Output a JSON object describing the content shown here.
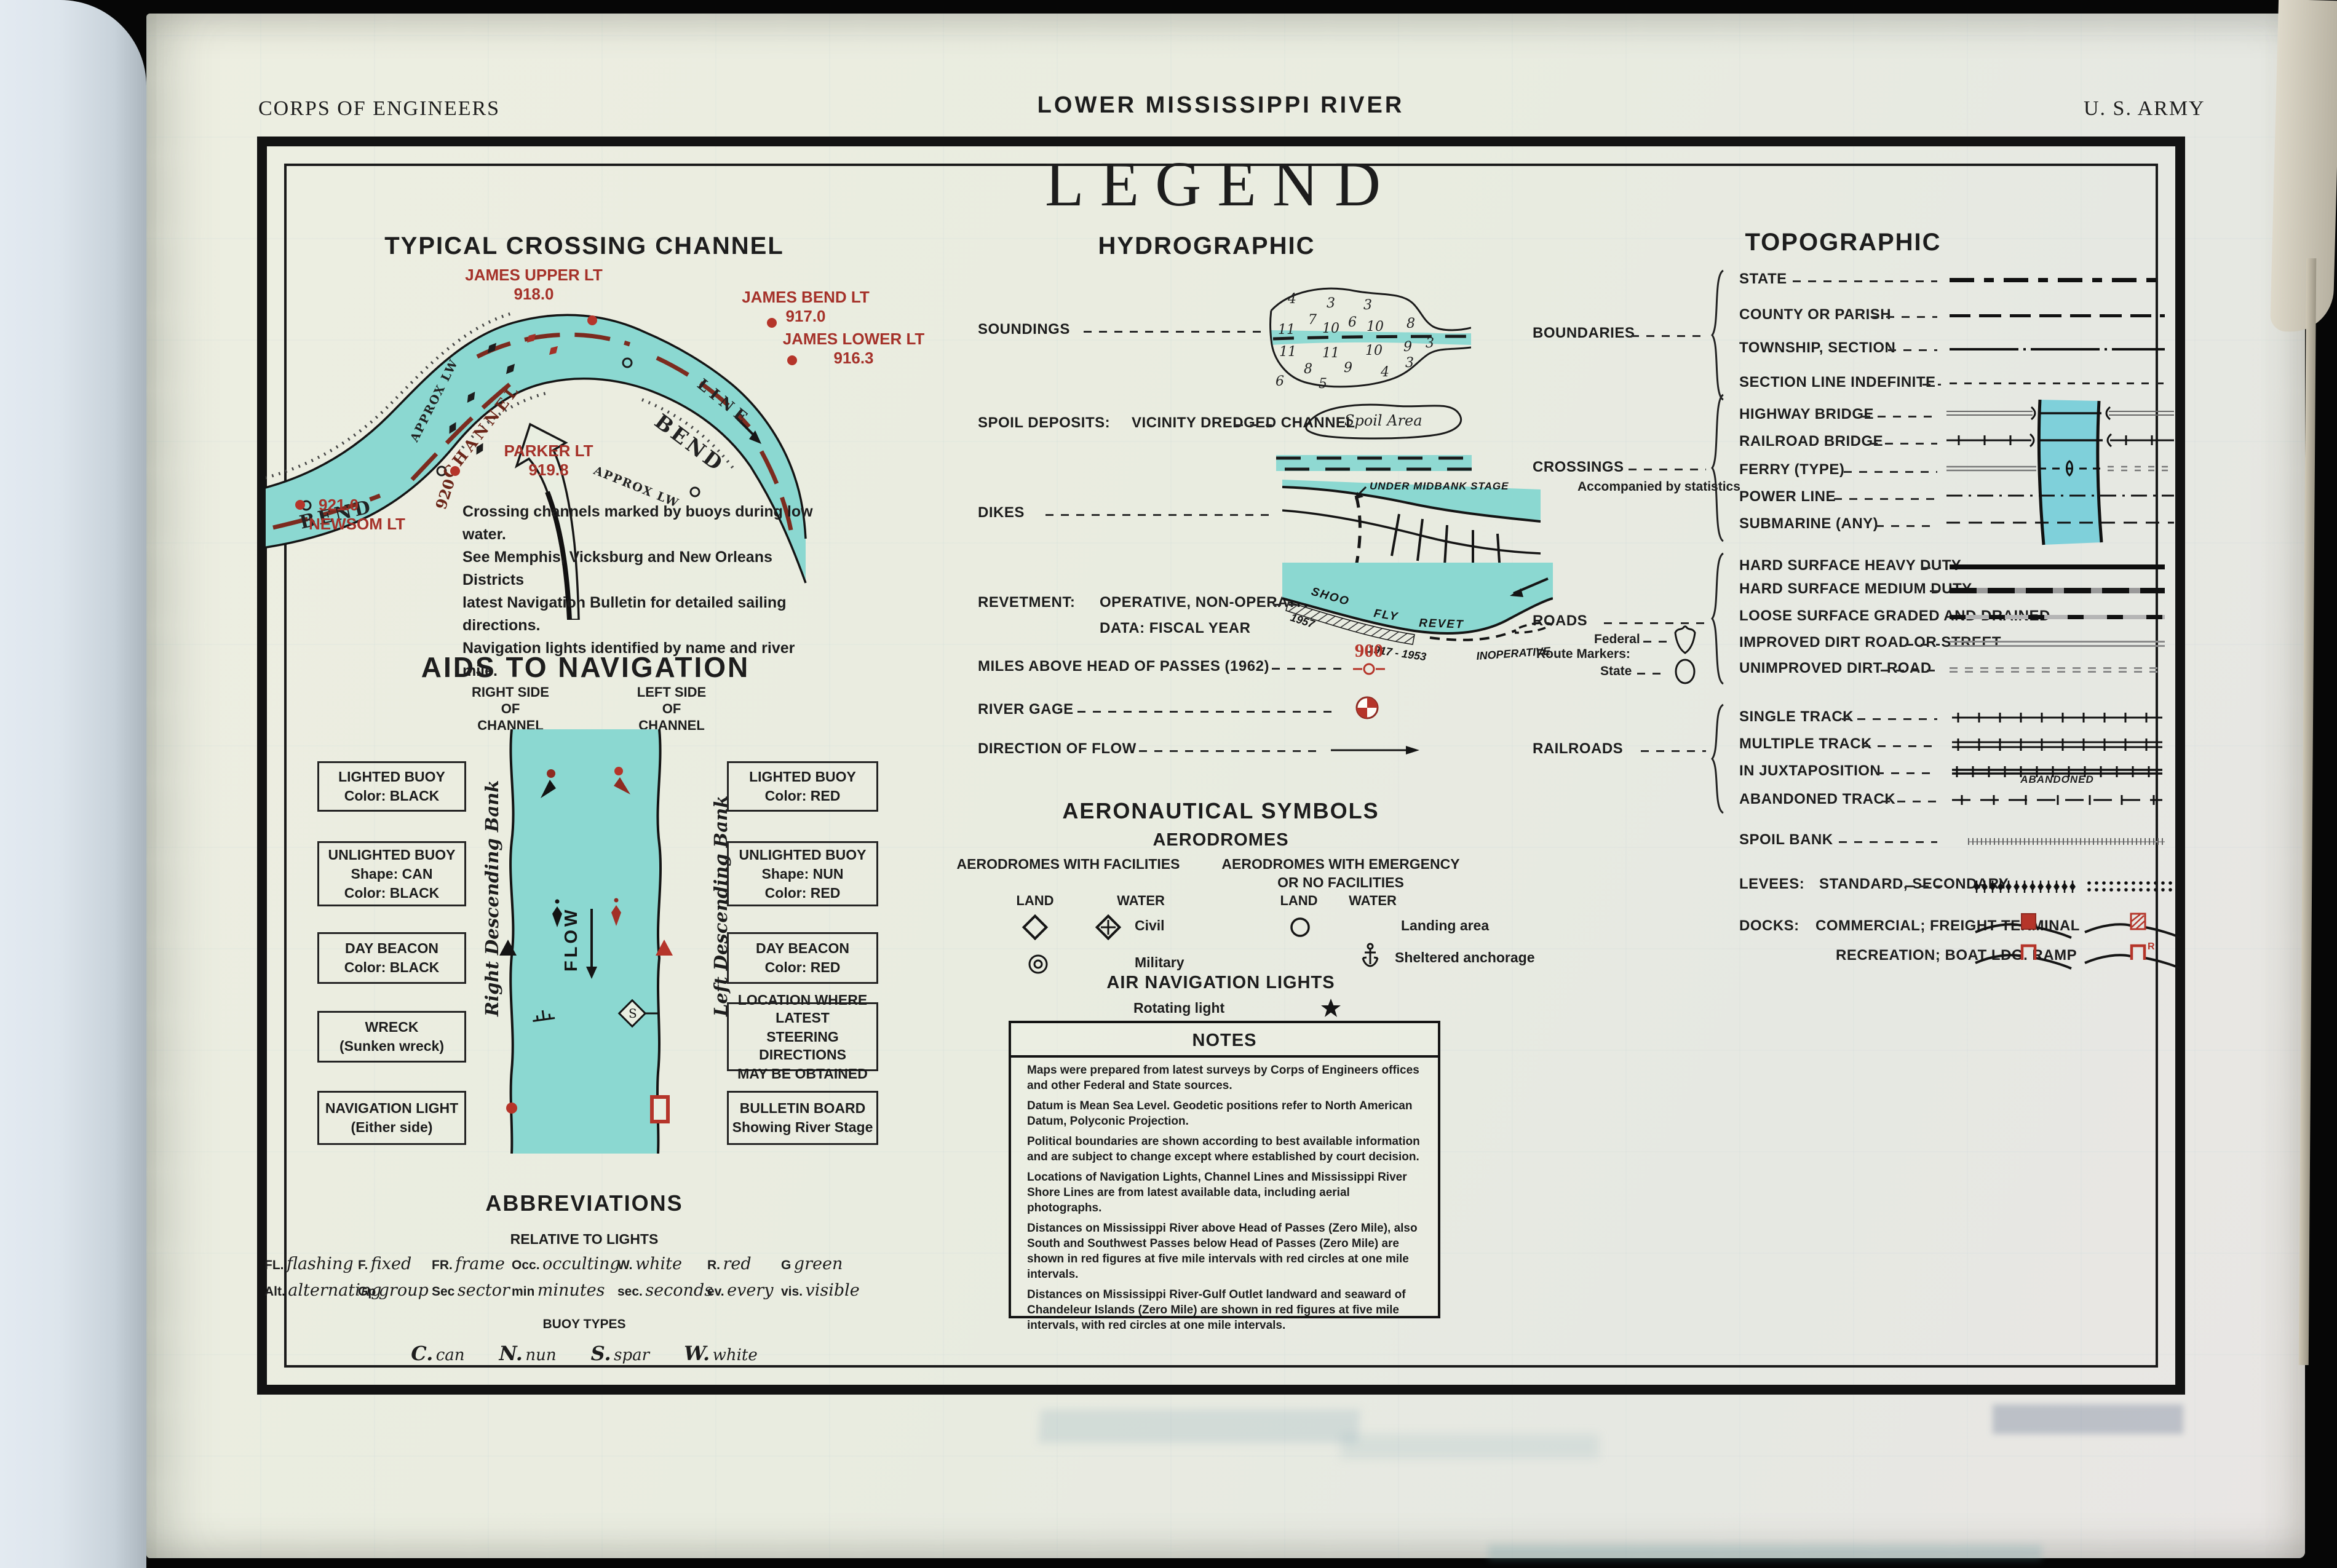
{
  "header": {
    "corps": "CORPS OF ENGINEERS",
    "river": "LOWER MISSISSIPPI RIVER",
    "army": "U. S. ARMY",
    "legend": "LEGEND"
  },
  "crossing": {
    "heading": "TYPICAL CROSSING CHANNEL",
    "james_upper": {
      "name": "JAMES UPPER LT",
      "mile": "918.0"
    },
    "james_bend": {
      "name": "JAMES BEND LT",
      "mile": "917.0"
    },
    "james_lower": {
      "name": "JAMES LOWER LT",
      "mile": "916.3"
    },
    "parker": {
      "name": "PARKER LT",
      "mile": "919.8"
    },
    "newsom": {
      "mile": "921.0",
      "name": "NEWSOM LT"
    },
    "words": {
      "bend_left": "BEND",
      "mile920": "920",
      "channel": "CHANNEL",
      "approx_lw": "APPROX LW",
      "line": "LINE",
      "bend_right": "BEND"
    },
    "note_lines": [
      "Crossing channels marked by buoys during low water.",
      "See Memphis, Vicksburg and New Orleans Districts",
      "latest Navigation Bulletin for detailed sailing directions.",
      "Navigation lights identified by name and river mile."
    ]
  },
  "aids": {
    "heading": "AIDS TO NAVIGATION",
    "right_side": [
      "RIGHT SIDE",
      "OF",
      "CHANNEL"
    ],
    "left_side": [
      "LEFT SIDE",
      "OF",
      "CHANNEL"
    ],
    "right_bank": "Right Descending Bank",
    "left_bank": "Left Descending Bank",
    "flow": "FLOW",
    "s_marker": "S",
    "left_boxes": [
      {
        "lines": [
          "LIGHTED BUOY",
          "Color: BLACK"
        ]
      },
      {
        "lines": [
          "UNLIGHTED BUOY",
          "Shape: CAN",
          "Color: BLACK"
        ]
      },
      {
        "lines": [
          "DAY BEACON",
          "Color: BLACK"
        ]
      },
      {
        "lines": [
          "WRECK",
          "(Sunken wreck)"
        ]
      },
      {
        "lines": [
          "NAVIGATION LIGHT",
          "(Either side)"
        ]
      }
    ],
    "right_boxes": [
      {
        "lines": [
          "LIGHTED BUOY",
          "Color: RED"
        ]
      },
      {
        "lines": [
          "UNLIGHTED BUOY",
          "Shape: NUN",
          "Color: RED"
        ]
      },
      {
        "lines": [
          "DAY BEACON",
          "Color: RED"
        ]
      },
      {
        "lines": [
          "LOCATION WHERE LATEST",
          "STEERING DIRECTIONS",
          "MAY BE OBTAINED"
        ]
      },
      {
        "lines": [
          "BULLETIN BOARD",
          "Showing River Stage"
        ]
      }
    ]
  },
  "abbr": {
    "heading": "ABBREVIATIONS",
    "lights_heading": "RELATIVE TO LIGHTS",
    "row1": [
      {
        "a": "FL.",
        "t": "flashing"
      },
      {
        "a": "F.",
        "t": "fixed"
      },
      {
        "a": "FR.",
        "t": "frame"
      },
      {
        "a": "Occ.",
        "t": "occulting"
      },
      {
        "a": "W.",
        "t": "white"
      },
      {
        "a": "R.",
        "t": "red"
      },
      {
        "a": "G",
        "t": "green"
      }
    ],
    "row2": [
      {
        "a": "Alt.",
        "t": "alternating"
      },
      {
        "a": "Gp",
        "t": "group"
      },
      {
        "a": "Sec",
        "t": "sector"
      },
      {
        "a": "min",
        "t": "minutes"
      },
      {
        "a": "sec.",
        "t": "seconds"
      },
      {
        "a": "ev.",
        "t": "every"
      },
      {
        "a": "vis.",
        "t": "visible"
      }
    ],
    "buoy_heading": "BUOY TYPES",
    "buoys": [
      {
        "a": "C.",
        "t": "can"
      },
      {
        "a": "N.",
        "t": "nun"
      },
      {
        "a": "S.",
        "t": "spar"
      },
      {
        "a": "W.",
        "t": "white"
      }
    ]
  },
  "hydro": {
    "heading": "HYDROGRAPHIC",
    "soundings_label": "SOUNDINGS",
    "soundings_rows": [
      [
        "4",
        "3",
        "3"
      ],
      [
        "7",
        "6"
      ],
      [
        "11",
        "10",
        "10",
        "8"
      ],
      [
        "11",
        "11",
        "10",
        "9",
        "3"
      ],
      [
        "8",
        "9",
        "4",
        "3"
      ],
      [
        "6",
        "5"
      ]
    ],
    "spoil_label": "SPOIL DEPOSITS:",
    "spoil_sub": "VICINITY DREDGED CHANNEL",
    "spoil_area": "Spoil    Area",
    "dikes_label": "DIKES",
    "dikes_note": "UNDER MIDBANK STAGE",
    "revet_label": "REVETMENT:",
    "revet_sub": "OPERATIVE, NON-OPERATIVE",
    "revet_data": "DATA:  FISCAL YEAR",
    "revet_words": {
      "shoo": "SHOO",
      "fly": "FLY",
      "revet": "REVET",
      "y1": "1957",
      "y2": "1917 - 1953",
      "inop": "INOPERATIVE"
    },
    "miles_label": "MILES ABOVE HEAD OF PASSES (1962)",
    "miles_value": "900",
    "gage_label": "RIVER GAGE",
    "flow_label": "DIRECTION OF FLOW"
  },
  "aero": {
    "heading": "AERONAUTICAL SYMBOLS",
    "sub": "AERODROMES",
    "fac": "AERODROMES WITH FACILITIES",
    "emerg1": "AERODROMES WITH EMERGENCY",
    "emerg2": "OR NO FACILITIES",
    "land": "LAND",
    "water": "WATER",
    "civil": "Civil",
    "military": "Military",
    "landing": "Landing area",
    "sheltered": "Sheltered anchorage",
    "lights": "AIR NAVIGATION LIGHTS",
    "rotating": "Rotating light"
  },
  "notes": {
    "heading": "NOTES",
    "paragraphs": [
      "Maps were prepared from latest surveys by Corps of Engineers offices and other Federal and State sources.",
      "Datum is Mean Sea Level. Geodetic positions refer to North American Datum, Polyconic Projection.",
      "Political boundaries are shown according to best available information and are subject to change except where established by court decision.",
      "Locations of Navigation Lights, Channel Lines and Mississippi River Shore Lines are from latest available data, including aerial photographs.",
      "Distances on Mississippi River above Head of Passes (Zero Mile), also South and Southwest Passes below Head of Passes (Zero Mile) are shown in red figures at five mile intervals with red circles at one mile intervals.",
      "Distances on Mississippi River-Gulf Outlet landward and seaward of Chandeleur Islands (Zero Mile) are shown in red figures at five mile intervals, with red circles at one mile intervals."
    ]
  },
  "topo": {
    "heading": "TOPOGRAPHIC",
    "boundaries_label": "BOUNDARIES",
    "boundaries": [
      {
        "label": "STATE"
      },
      {
        "label": "COUNTY OR PARISH"
      },
      {
        "label": "TOWNSHIP,  SECTION"
      },
      {
        "label": "SECTION LINE INDEFINITE"
      }
    ],
    "crossings_label": "CROSSINGS",
    "crossings_note": "Accompanied by statistics",
    "crossings": [
      {
        "label": "HIGHWAY BRIDGE"
      },
      {
        "label": "RAILROAD BRIDGE"
      },
      {
        "label": "FERRY  (TYPE)"
      },
      {
        "label": "POWER LINE"
      },
      {
        "label": "SUBMARINE  (ANY)"
      }
    ],
    "roads_label": "ROADS",
    "route_markers": "Route Markers:",
    "federal": "Federal",
    "state": "State",
    "roads": [
      {
        "label": "HARD SURFACE HEAVY DUTY"
      },
      {
        "label": "HARD SURFACE MEDIUM DUTY"
      },
      {
        "label": "LOOSE SURFACE GRADED AND DRAINED"
      },
      {
        "label": "IMPROVED DIRT ROAD OR STREET"
      },
      {
        "label": "UNIMPROVED DIRT ROAD"
      }
    ],
    "railroads_label": "RAILROADS",
    "railroads": [
      {
        "label": "SINGLE TRACK"
      },
      {
        "label": "MULTIPLE TRACK"
      },
      {
        "label": "IN JUXTAPOSITION"
      },
      {
        "label": "ABANDONED TRACK"
      }
    ],
    "abandoned_note": "ABANDONED",
    "spoil_bank": "SPOIL BANK",
    "levees_label": "LEVEES:",
    "levees_sub": "STANDARD,  SECONDARY",
    "docks_label": "DOCKS:",
    "docks_sub": "COMMERCIAL;  FREIGHT TERMINAL",
    "recreation_sub": "RECREATION;  BOAT LDG. RAMP"
  },
  "colors": {
    "paper": "#e9ece0",
    "ink": "#1d1d1d",
    "water": "#8bd8d1",
    "band": "#7fd0da",
    "red": "#b5352a",
    "dark_red": "#8e2b21",
    "label_red": "#a5322a",
    "gray_line": "#8a8a8a"
  }
}
